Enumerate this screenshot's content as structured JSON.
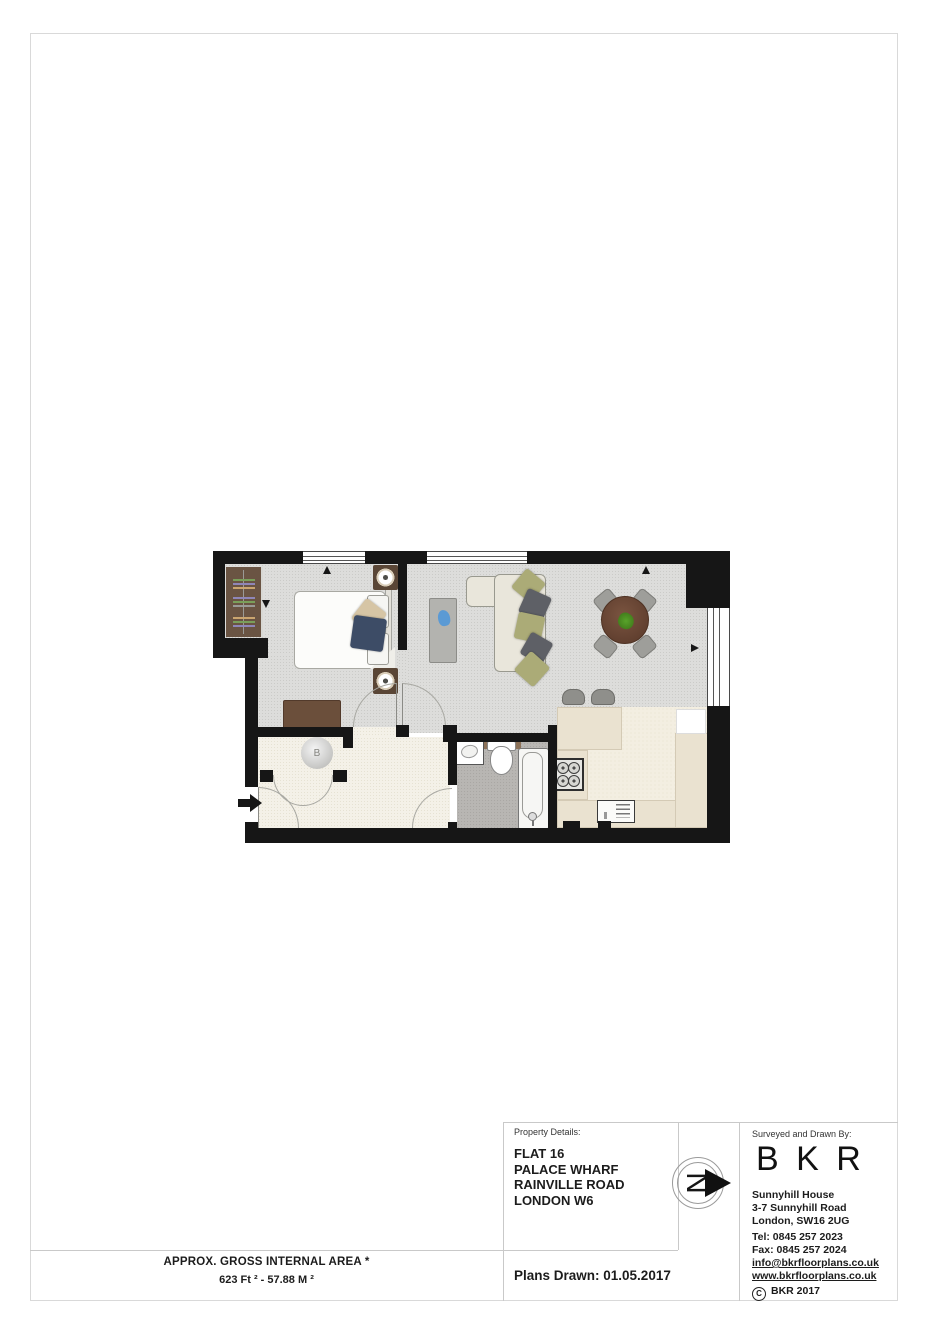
{
  "document": {
    "type": "floorplan-page",
    "area_summary": {
      "title": "APPROX. GROSS INTERNAL AREA *",
      "value": "623 Ft ²  -  57.88 M ²"
    },
    "title_block": {
      "property_details_label": "Property Details:",
      "property_address": [
        "FLAT 16",
        "PALACE WHARF",
        "RAINVILLE ROAD",
        "LONDON W6"
      ],
      "plans_drawn_label": "Plans Drawn: 01.05.2017",
      "surveyed_label": "Surveyed and Drawn By:",
      "company_logo": "B K R",
      "company_address": [
        "Sunnyhill House",
        "3-7 Sunnyhill Road",
        "London, SW16 2UG"
      ],
      "tel": "Tel:  0845 257 2023",
      "fax": "Fax: 0845 257 2024",
      "email": "info@bkrfloorplans.co.uk",
      "website": "www.bkrfloorplans.co.uk",
      "copyright_symbol": "C",
      "copyright_text": "BKR 2017",
      "north_letter": "N"
    },
    "floorplan": {
      "boiler_label": "B",
      "colors": {
        "wall": "#161616",
        "carpet": "#dddddb",
        "hall_floor": "#f4f1e8",
        "bathroom_floor": "#b8b6b3",
        "kitchen_floor": "#f3eee1",
        "kitchen_counter": "#eae2d0",
        "wood_brown": "#6a5443",
        "sofa_cream": "#e9e6db",
        "cushion_olive": "#abab77",
        "cushion_gray": "#5e6066",
        "cushion_navy": "#3d4c66",
        "dining_table_brown": "#6d4936",
        "plant_green": "#4a8c22",
        "bathroom_counter": "#8d7258"
      }
    }
  }
}
